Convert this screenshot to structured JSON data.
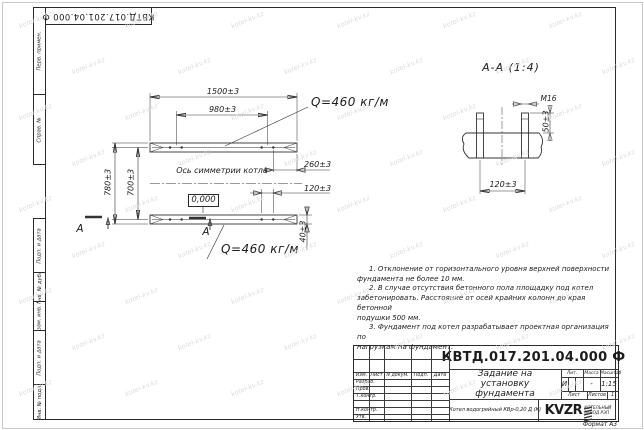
{
  "page": {
    "format_label": "Формат А3"
  },
  "corner_stamp": {
    "doc_number": "КВТД.017.201.04.000 Ф"
  },
  "margin_labels": {
    "items": [
      "Перв. примен.",
      "Справ. №",
      "Подп. и дата",
      "Инв. № дубл.",
      "Взам. инв. №",
      "Подп. и дата",
      "Инв. № подл."
    ]
  },
  "plan": {
    "dim_length": "1500±3",
    "dim_bolt_span": "980±3",
    "dim_width": "780±3",
    "dim_inner_width": "700±3",
    "dim_end_offset": "260±3",
    "dim_bolt_pitch": "120±3",
    "dim_channel": "40±3",
    "load_top": "Q=460 кг/м",
    "load_bottom": "Q=460 кг/м",
    "axis_label": "Ось симметрии котла",
    "level_mark": "0,000",
    "section_letter": "А"
  },
  "section": {
    "title": "А-А (1:4)",
    "thread_label": "М16",
    "dim_protrusion": "50±3",
    "dim_pitch": "120±3"
  },
  "notes": {
    "lines": [
      "1. Отклонение от горизонтального уровня верхней поверхности",
      "фундамента не более 10 мм.",
      "2. В случае отсутствия бетонного пола площадку под котел",
      "забетонировать. Расстояние от осей крайних колонн до края бетонной",
      "подушки 500 мм.",
      "3. Фундамент под котел разрабатывает проектная организация по",
      "нагрузкам на фундамент."
    ]
  },
  "title_block": {
    "doc_number": "КВТД.017.201.04.000 Ф",
    "title_line1": "Задание на",
    "title_line2": "установку",
    "title_line3": "фундамента",
    "col_izm": "Изм.",
    "col_list": "Лист",
    "col_doc": "N докум.",
    "col_podp": "Подп.",
    "col_data": "Дата",
    "row_razrab": "Разраб.",
    "row_prov": "Пров.",
    "row_tkontr": "Т.контр.",
    "row_nkontr": "Н.контр.",
    "row_utv": "Утв.",
    "lit_label": "Лит.",
    "lit_value": "И",
    "mass_label": "Масса",
    "mass_value": "-",
    "scale_label": "Масштаб",
    "scale_value": "1:15",
    "sheet_label": "Лист",
    "sheets_label": "Листов",
    "sheets_value": "1",
    "product": "Котел водогрейный КВр-0,20 Д (К)",
    "brand": "KVZR",
    "brand_line1": "КОТЕЛЬНЫЙ",
    "brand_line2": "ЗАВОД РЭП"
  },
  "watermark": {
    "text": "kotel-kv.kz"
  }
}
